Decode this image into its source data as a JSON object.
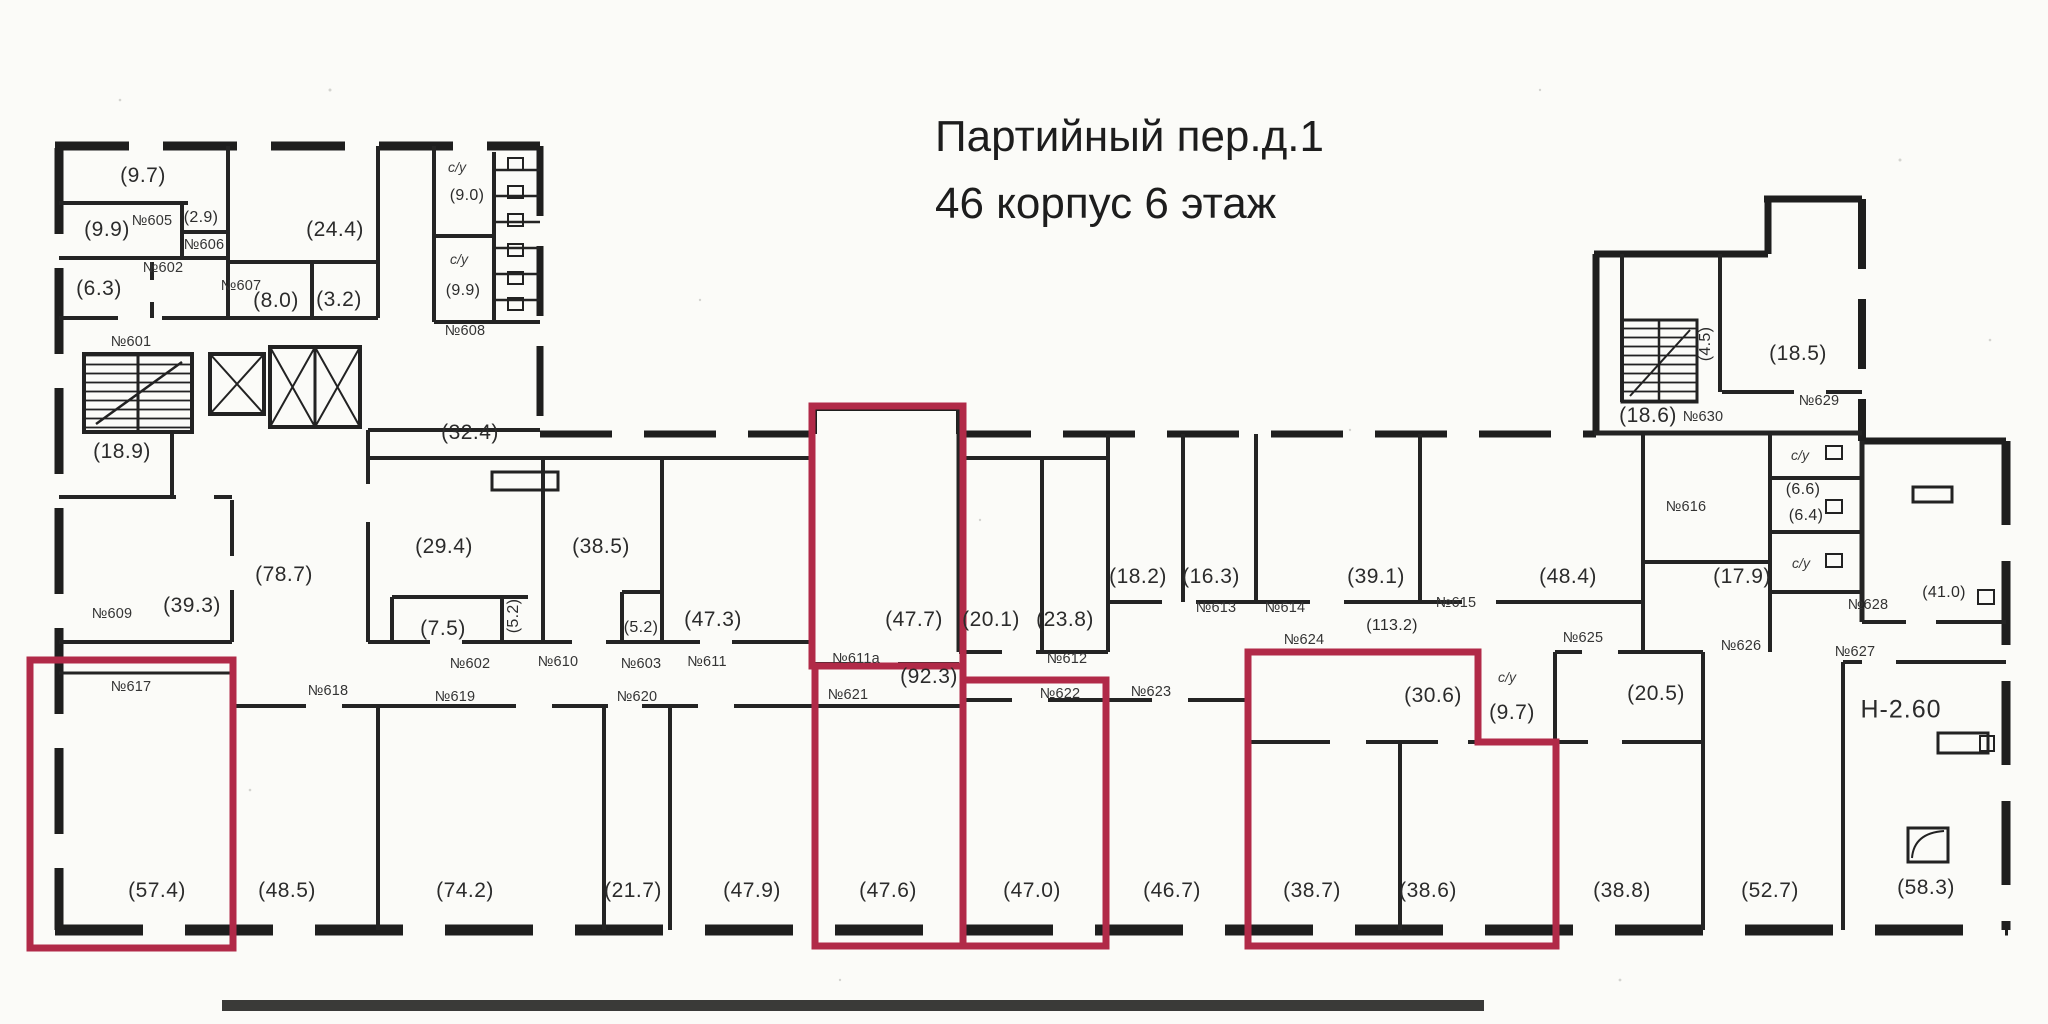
{
  "title": {
    "line1": "Партийный пер.д.1",
    "line2": "46 корпус 6 этаж"
  },
  "colors": {
    "paper": "#fbfbf8",
    "wall": "#1e1e1e",
    "ink": "#2b2b2b",
    "highlight": "#b12a48"
  },
  "labels": [
    {
      "text": "(9.7)",
      "x": 143,
      "y": 176,
      "type": "area"
    },
    {
      "text": "(9.9)",
      "x": 107,
      "y": 230,
      "type": "area"
    },
    {
      "text": "№605",
      "x": 152,
      "y": 221,
      "type": "num"
    },
    {
      "text": "(2.9)",
      "x": 201,
      "y": 218,
      "type": "area-sm"
    },
    {
      "text": "№606",
      "x": 204,
      "y": 245,
      "type": "num"
    },
    {
      "text": "№602",
      "x": 163,
      "y": 268,
      "type": "num"
    },
    {
      "text": "(6.3)",
      "x": 99,
      "y": 289,
      "type": "area"
    },
    {
      "text": "(24.4)",
      "x": 335,
      "y": 230,
      "type": "area"
    },
    {
      "text": "№607",
      "x": 241,
      "y": 286,
      "type": "num"
    },
    {
      "text": "(8.0)",
      "x": 276,
      "y": 301,
      "type": "area"
    },
    {
      "text": "(3.2)",
      "x": 339,
      "y": 300,
      "type": "area"
    },
    {
      "text": "с/у",
      "x": 457,
      "y": 167,
      "type": "cy"
    },
    {
      "text": "(9.0)",
      "x": 467,
      "y": 196,
      "type": "area-sm"
    },
    {
      "text": "с/у",
      "x": 459,
      "y": 259,
      "type": "cy"
    },
    {
      "text": "(9.9)",
      "x": 463,
      "y": 291,
      "type": "area-sm"
    },
    {
      "text": "№608",
      "x": 465,
      "y": 331,
      "type": "num"
    },
    {
      "text": "№601",
      "x": 131,
      "y": 342,
      "type": "num"
    },
    {
      "text": "(18.9)",
      "x": 122,
      "y": 452,
      "type": "area"
    },
    {
      "text": "(32.4)",
      "x": 470,
      "y": 433,
      "type": "area"
    },
    {
      "text": "(78.7)",
      "x": 284,
      "y": 575,
      "type": "area"
    },
    {
      "text": "№609",
      "x": 112,
      "y": 614,
      "type": "num"
    },
    {
      "text": "(39.3)",
      "x": 192,
      "y": 606,
      "type": "area"
    },
    {
      "text": "(29.4)",
      "x": 444,
      "y": 547,
      "type": "area"
    },
    {
      "text": "(38.5)",
      "x": 601,
      "y": 547,
      "type": "area"
    },
    {
      "text": "(7.5)",
      "x": 443,
      "y": 629,
      "type": "area"
    },
    {
      "text": "(5.2)",
      "x": 514,
      "y": 616,
      "type": "area-sm",
      "rot": true
    },
    {
      "text": "№602",
      "x": 470,
      "y": 664,
      "type": "num"
    },
    {
      "text": "№610",
      "x": 558,
      "y": 662,
      "type": "num"
    },
    {
      "text": "(5.2)",
      "x": 641,
      "y": 628,
      "type": "area-sm"
    },
    {
      "text": "№603",
      "x": 641,
      "y": 664,
      "type": "num"
    },
    {
      "text": "(47.3)",
      "x": 713,
      "y": 620,
      "type": "area"
    },
    {
      "text": "№611",
      "x": 707,
      "y": 662,
      "type": "num"
    },
    {
      "text": "(47.7)",
      "x": 914,
      "y": 620,
      "type": "area"
    },
    {
      "text": "№611а",
      "x": 856,
      "y": 659,
      "type": "num"
    },
    {
      "text": "(92.3)",
      "x": 929,
      "y": 677,
      "type": "area"
    },
    {
      "text": "(20.1)",
      "x": 991,
      "y": 620,
      "type": "area"
    },
    {
      "text": "(23.8)",
      "x": 1065,
      "y": 620,
      "type": "area"
    },
    {
      "text": "№612",
      "x": 1067,
      "y": 659,
      "type": "num"
    },
    {
      "text": "(18.2)",
      "x": 1138,
      "y": 577,
      "type": "area"
    },
    {
      "text": "(16.3)",
      "x": 1211,
      "y": 577,
      "type": "area"
    },
    {
      "text": "№613",
      "x": 1216,
      "y": 608,
      "type": "num"
    },
    {
      "text": "№614",
      "x": 1285,
      "y": 608,
      "type": "num"
    },
    {
      "text": "(39.1)",
      "x": 1376,
      "y": 577,
      "type": "area"
    },
    {
      "text": "№615",
      "x": 1456,
      "y": 603,
      "type": "num"
    },
    {
      "text": "(48.4)",
      "x": 1568,
      "y": 577,
      "type": "area"
    },
    {
      "text": "(17.9)",
      "x": 1742,
      "y": 577,
      "type": "area"
    },
    {
      "text": "(113.2)",
      "x": 1392,
      "y": 626,
      "type": "area-sm"
    },
    {
      "text": "№624",
      "x": 1304,
      "y": 640,
      "type": "num"
    },
    {
      "text": "(30.6)",
      "x": 1433,
      "y": 696,
      "type": "area"
    },
    {
      "text": "с/у",
      "x": 1507,
      "y": 677,
      "type": "cy"
    },
    {
      "text": "(9.7)",
      "x": 1512,
      "y": 713,
      "type": "area"
    },
    {
      "text": "№625",
      "x": 1583,
      "y": 638,
      "type": "num"
    },
    {
      "text": "(20.5)",
      "x": 1656,
      "y": 694,
      "type": "area"
    },
    {
      "text": "№626",
      "x": 1741,
      "y": 646,
      "type": "num"
    },
    {
      "text": "№616",
      "x": 1686,
      "y": 507,
      "type": "num"
    },
    {
      "text": "(4.5)",
      "x": 1706,
      "y": 344,
      "type": "area-sm",
      "rot": true
    },
    {
      "text": "(18.5)",
      "x": 1798,
      "y": 354,
      "type": "area"
    },
    {
      "text": "№629",
      "x": 1819,
      "y": 401,
      "type": "num"
    },
    {
      "text": "(18.6)",
      "x": 1648,
      "y": 416,
      "type": "area"
    },
    {
      "text": "№630",
      "x": 1703,
      "y": 417,
      "type": "num"
    },
    {
      "text": "с/у",
      "x": 1800,
      "y": 455,
      "type": "cy"
    },
    {
      "text": "(6.6)",
      "x": 1803,
      "y": 490,
      "type": "area-sm"
    },
    {
      "text": "(6.4)",
      "x": 1806,
      "y": 516,
      "type": "area-sm"
    },
    {
      "text": "с/у",
      "x": 1801,
      "y": 563,
      "type": "cy"
    },
    {
      "text": "№628",
      "x": 1868,
      "y": 605,
      "type": "num"
    },
    {
      "text": "(41.0)",
      "x": 1944,
      "y": 593,
      "type": "area-sm"
    },
    {
      "text": "№627",
      "x": 1855,
      "y": 652,
      "type": "num"
    },
    {
      "text": "Н-2.60",
      "x": 1901,
      "y": 710,
      "type": "big"
    },
    {
      "text": "№617",
      "x": 131,
      "y": 687,
      "type": "num"
    },
    {
      "text": "№618",
      "x": 328,
      "y": 691,
      "type": "num"
    },
    {
      "text": "№619",
      "x": 455,
      "y": 697,
      "type": "num"
    },
    {
      "text": "№620",
      "x": 637,
      "y": 697,
      "type": "num"
    },
    {
      "text": "№621",
      "x": 848,
      "y": 695,
      "type": "num"
    },
    {
      "text": "№622",
      "x": 1060,
      "y": 694,
      "type": "num"
    },
    {
      "text": "№623",
      "x": 1151,
      "y": 692,
      "type": "num"
    },
    {
      "text": "(57.4)",
      "x": 157,
      "y": 891,
      "type": "area"
    },
    {
      "text": "(48.5)",
      "x": 287,
      "y": 891,
      "type": "area"
    },
    {
      "text": "(74.2)",
      "x": 465,
      "y": 891,
      "type": "area"
    },
    {
      "text": "(21.7)",
      "x": 633,
      "y": 891,
      "type": "area"
    },
    {
      "text": "(47.9)",
      "x": 752,
      "y": 891,
      "type": "area"
    },
    {
      "text": "(47.6)",
      "x": 888,
      "y": 891,
      "type": "area"
    },
    {
      "text": "(47.0)",
      "x": 1032,
      "y": 891,
      "type": "area"
    },
    {
      "text": "(46.7)",
      "x": 1172,
      "y": 891,
      "type": "area"
    },
    {
      "text": "(38.7)",
      "x": 1312,
      "y": 891,
      "type": "area"
    },
    {
      "text": "(38.6)",
      "x": 1428,
      "y": 891,
      "type": "area"
    },
    {
      "text": "(38.8)",
      "x": 1622,
      "y": 891,
      "type": "area"
    },
    {
      "text": "(52.7)",
      "x": 1770,
      "y": 891,
      "type": "area"
    },
    {
      "text": "(58.3)",
      "x": 1926,
      "y": 888,
      "type": "area"
    }
  ]
}
